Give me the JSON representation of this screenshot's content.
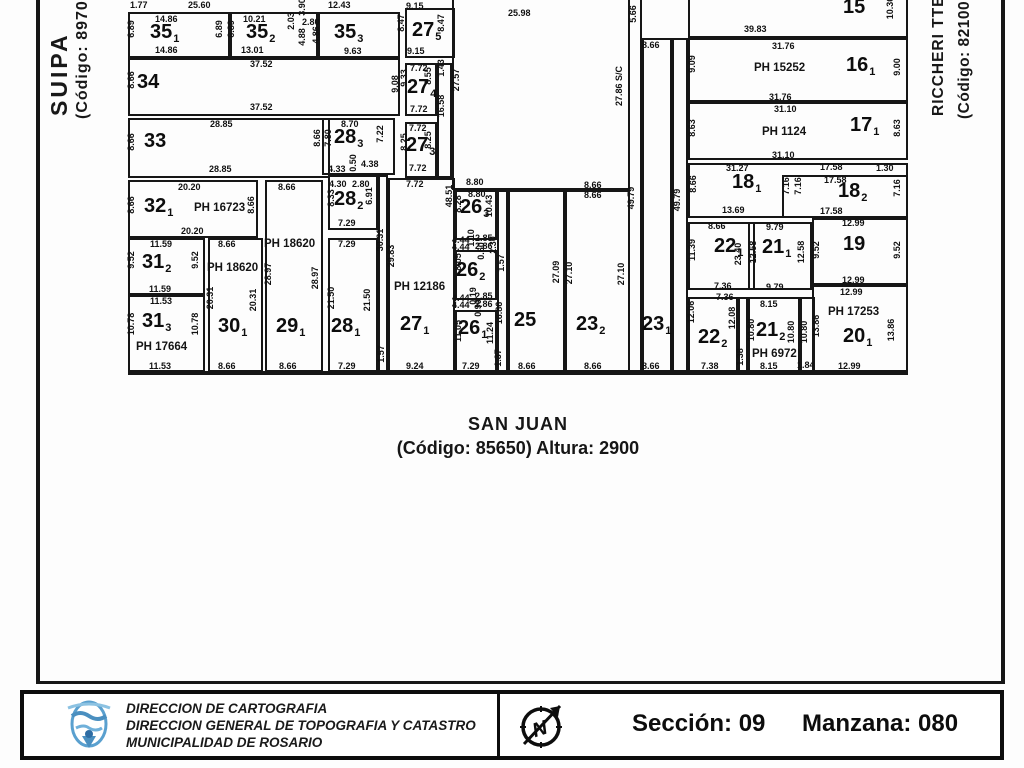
{
  "streets": {
    "left": {
      "name": "SUIPA",
      "code": "(Código: 89700"
    },
    "right": {
      "name": "RICCHERI TTE.",
      "code": "(Código: 82100"
    },
    "bottom": {
      "name": "SAN JUAN",
      "code": "(Código: 85650) Altura: 2900"
    }
  },
  "footer": {
    "org_lines": [
      "DIRECCION DE CARTOGRAFIA",
      "DIRECCION GENERAL DE TOPOGRAFIA Y CATASTRO",
      "MUNICIPALIDAD DE ROSARIO"
    ],
    "section_label": "Sección: 09",
    "manzana_label": "Manzana: 080",
    "compass_letter": "N"
  },
  "map": {
    "line_color": "#161616",
    "rects": [
      [
        128,
        12,
        102,
        46
      ],
      [
        230,
        12,
        88,
        46
      ],
      [
        318,
        12,
        82,
        46
      ],
      [
        405,
        8,
        50,
        50
      ],
      [
        128,
        58,
        272,
        58
      ],
      [
        405,
        63,
        32,
        53
      ],
      [
        437,
        63,
        15,
        115
      ],
      [
        128,
        118,
        202,
        60
      ],
      [
        322,
        118,
        73,
        57
      ],
      [
        405,
        122,
        32,
        56
      ],
      [
        128,
        180,
        130,
        58
      ],
      [
        328,
        175,
        50,
        55
      ],
      [
        128,
        238,
        77,
        57
      ],
      [
        128,
        295,
        77,
        77
      ],
      [
        208,
        238,
        55,
        134
      ],
      [
        265,
        180,
        58,
        192
      ],
      [
        328,
        238,
        50,
        134
      ],
      [
        378,
        175,
        10,
        197
      ],
      [
        388,
        178,
        67,
        194
      ],
      [
        452,
        -10,
        178,
        200
      ],
      [
        455,
        190,
        42,
        50
      ],
      [
        455,
        250,
        42,
        50
      ],
      [
        455,
        310,
        42,
        62
      ],
      [
        497,
        190,
        11,
        182
      ],
      [
        508,
        190,
        57,
        182
      ],
      [
        565,
        190,
        65,
        182
      ],
      [
        628,
        -10,
        14,
        382
      ],
      [
        642,
        38,
        30,
        334
      ],
      [
        672,
        38,
        16,
        334
      ],
      [
        688,
        -10,
        220,
        48
      ],
      [
        688,
        38,
        220,
        64
      ],
      [
        688,
        102,
        220,
        58
      ],
      [
        688,
        163,
        220,
        55
      ],
      [
        782,
        175,
        126,
        43
      ],
      [
        688,
        222,
        67,
        68
      ],
      [
        748,
        222,
        64,
        68
      ],
      [
        812,
        218,
        96,
        67
      ],
      [
        688,
        297,
        50,
        75
      ],
      [
        738,
        297,
        10,
        75
      ],
      [
        748,
        297,
        52,
        75
      ],
      [
        800,
        297,
        15,
        75
      ],
      [
        812,
        285,
        96,
        87
      ],
      [
        128,
        371,
        780,
        4,
        1
      ],
      [
        36,
        0,
        4,
        684,
        1
      ],
      [
        1001,
        0,
        4,
        684,
        1
      ],
      [
        36,
        681,
        969,
        3,
        1
      ]
    ],
    "parcels": [
      [
        "35",
        "1",
        150,
        22
      ],
      [
        "35",
        "2",
        246,
        22
      ],
      [
        "35",
        "3",
        334,
        22
      ],
      [
        "27",
        "5",
        412,
        20
      ],
      [
        "34",
        "",
        137,
        72
      ],
      [
        "27",
        "4",
        407,
        77
      ],
      [
        "33",
        "",
        144,
        131
      ],
      [
        "28",
        "3",
        334,
        127
      ],
      [
        "27",
        "3",
        406,
        135
      ],
      [
        "32",
        "1",
        144,
        196
      ],
      [
        "28",
        "2",
        334,
        189
      ],
      [
        "31",
        "2",
        142,
        252
      ],
      [
        "31",
        "3",
        142,
        311
      ],
      [
        "30",
        "1",
        218,
        316
      ],
      [
        "29",
        "1",
        276,
        316
      ],
      [
        "28",
        "1",
        331,
        316
      ],
      [
        "27",
        "1",
        400,
        314
      ],
      [
        "26",
        "3",
        460,
        197
      ],
      [
        "26",
        "2",
        456,
        260
      ],
      [
        "26",
        "1",
        458,
        318
      ],
      [
        "25",
        "",
        514,
        310
      ],
      [
        "23",
        "2",
        576,
        314
      ],
      [
        "23",
        "1",
        642,
        314
      ],
      [
        "15",
        "",
        843,
        -3
      ],
      [
        "16",
        "1",
        846,
        55
      ],
      [
        "17",
        "1",
        850,
        115
      ],
      [
        "18",
        "1",
        732,
        172
      ],
      [
        "18",
        "2",
        838,
        181
      ],
      [
        "22",
        "1",
        714,
        236
      ],
      [
        "21",
        "1",
        762,
        237
      ],
      [
        "19",
        "",
        843,
        234
      ],
      [
        "22",
        "2",
        698,
        327
      ],
      [
        "21",
        "2",
        756,
        320
      ],
      [
        "20",
        "1",
        843,
        326
      ]
    ],
    "ph_labels": [
      [
        "PH 16723",
        194,
        202
      ],
      [
        "PH 18620",
        264,
        238
      ],
      [
        "PH 18620",
        207,
        262
      ],
      [
        "PH 17664",
        136,
        341
      ],
      [
        "PH 12186",
        394,
        281
      ],
      [
        "PH 15252",
        754,
        62
      ],
      [
        "PH 1124",
        762,
        126
      ],
      [
        "PH 17253",
        828,
        306
      ],
      [
        "PH 6972",
        752,
        348
      ]
    ],
    "measurements": [
      [
        "1.77",
        130,
        1
      ],
      [
        "25.60",
        188,
        1
      ],
      [
        "12.43",
        328,
        1
      ],
      [
        "9.15",
        406,
        2
      ],
      [
        "25.98",
        508,
        9
      ],
      [
        "39.83",
        744,
        25
      ],
      [
        "8.66",
        642,
        41
      ],
      [
        "5.66",
        629,
        14,
        1
      ],
      [
        "10.36",
        886,
        8,
        1
      ],
      [
        "14.86",
        155,
        15
      ],
      [
        "6.89",
        127,
        29,
        1
      ],
      [
        "6.89",
        215,
        29,
        1
      ],
      [
        "14.86",
        155,
        46
      ],
      [
        "10.21",
        243,
        15
      ],
      [
        "6.89",
        227,
        29,
        1
      ],
      [
        "13.01",
        241,
        46
      ],
      [
        "2.03",
        287,
        21,
        1
      ],
      [
        "3.90",
        298,
        7,
        1
      ],
      [
        "2.80",
        302,
        18
      ],
      [
        "4.88",
        298,
        37,
        1
      ],
      [
        "4.86",
        312,
        35,
        1
      ],
      [
        "9.63",
        344,
        47
      ],
      [
        "8.47",
        397,
        23,
        1
      ],
      [
        "8.47",
        437,
        23,
        1
      ],
      [
        "9.15",
        407,
        47
      ],
      [
        "37.52",
        250,
        60
      ],
      [
        "8.66",
        127,
        80,
        1
      ],
      [
        "37.52",
        250,
        103
      ],
      [
        "9.08",
        391,
        84,
        1
      ],
      [
        "7.72",
        410,
        64
      ],
      [
        "9.33",
        400,
        78,
        1
      ],
      [
        "8.55",
        424,
        76,
        1
      ],
      [
        "7.72",
        410,
        105
      ],
      [
        "1.43",
        437,
        68,
        1
      ],
      [
        "16.58",
        437,
        106,
        1
      ],
      [
        "28.85",
        210,
        120
      ],
      [
        "8.66",
        127,
        142,
        1
      ],
      [
        "8.66",
        313,
        138,
        1
      ],
      [
        "28.85",
        209,
        165
      ],
      [
        "8.70",
        341,
        120
      ],
      [
        "7.80",
        324,
        138,
        1
      ],
      [
        "7.22",
        376,
        134,
        1
      ],
      [
        "4.33",
        328,
        165
      ],
      [
        "0.50",
        349,
        163,
        1
      ],
      [
        "4.38",
        361,
        160
      ],
      [
        "7.72",
        409,
        124
      ],
      [
        "8.25",
        400,
        142,
        1
      ],
      [
        "8.25",
        424,
        140,
        1
      ],
      [
        "7.72",
        409,
        164
      ],
      [
        "7.72",
        406,
        180
      ],
      [
        "20.20",
        178,
        183
      ],
      [
        "8.66",
        127,
        205,
        1
      ],
      [
        "8.66",
        247,
        205,
        1
      ],
      [
        "20.20",
        181,
        227
      ],
      [
        "4.30",
        329,
        180
      ],
      [
        "2.80",
        352,
        180
      ],
      [
        "8.33",
        327,
        198,
        1
      ],
      [
        "6.91",
        365,
        196,
        1
      ],
      [
        "7.29",
        338,
        219
      ],
      [
        "8.66",
        278,
        183
      ],
      [
        "28.97",
        264,
        274,
        1
      ],
      [
        "28.97",
        311,
        278,
        1
      ],
      [
        "8.66",
        279,
        362
      ],
      [
        "11.59",
        150,
        240
      ],
      [
        "9.52",
        127,
        260,
        1
      ],
      [
        "9.52",
        191,
        260,
        1
      ],
      [
        "11.59",
        149,
        285
      ],
      [
        "11.53",
        150,
        297
      ],
      [
        "10.78",
        127,
        324,
        1
      ],
      [
        "10.78",
        191,
        324,
        1
      ],
      [
        "11.53",
        149,
        362
      ],
      [
        "8.66",
        218,
        240
      ],
      [
        "20.31",
        206,
        298,
        1
      ],
      [
        "20.31",
        249,
        300,
        1
      ],
      [
        "8.66",
        218,
        362
      ],
      [
        "7.29",
        338,
        240
      ],
      [
        "21.50",
        327,
        298,
        1
      ],
      [
        "21.50",
        363,
        300,
        1
      ],
      [
        "7.29",
        338,
        362
      ],
      [
        "1.57",
        377,
        354,
        1
      ],
      [
        "30.31",
        376,
        240,
        1
      ],
      [
        "29.83",
        387,
        256,
        1
      ],
      [
        "48.51",
        445,
        196,
        1
      ],
      [
        "9.24",
        406,
        362
      ],
      [
        "27.57",
        452,
        80,
        1
      ],
      [
        "27.86 S/C",
        615,
        86,
        1
      ],
      [
        "8.80",
        466,
        178
      ],
      [
        "8.80",
        468,
        190
      ],
      [
        "8.28",
        454,
        204,
        1
      ],
      [
        "10.43",
        485,
        206,
        1
      ],
      [
        "4.44",
        452,
        236
      ],
      [
        "2.85",
        475,
        234
      ],
      [
        "1.10",
        467,
        238,
        1
      ],
      [
        "4.44",
        452,
        243
      ],
      [
        "2.86",
        475,
        242
      ],
      [
        "2.30",
        489,
        245,
        1
      ],
      [
        "8.05",
        454,
        262,
        1
      ],
      [
        "0.60",
        477,
        251,
        1
      ],
      [
        "1.57",
        497,
        263,
        1
      ],
      [
        "4.44",
        452,
        294
      ],
      [
        "2.85",
        475,
        292
      ],
      [
        "0.19",
        469,
        296,
        1
      ],
      [
        "4.44",
        452,
        301
      ],
      [
        "2.86",
        475,
        300
      ],
      [
        "0.90",
        474,
        308,
        1
      ],
      [
        "11.05",
        454,
        331,
        1
      ],
      [
        "11.24",
        486,
        333,
        1
      ],
      [
        "7.29",
        462,
        362
      ],
      [
        "16.86",
        495,
        313,
        1
      ],
      [
        "1.37",
        494,
        358,
        1
      ],
      [
        "27.09",
        552,
        272,
        1
      ],
      [
        "8.66",
        518,
        362
      ],
      [
        "8.66",
        584,
        181
      ],
      [
        "8.66",
        584,
        191
      ],
      [
        "27.10",
        565,
        273,
        1
      ],
      [
        "27.10",
        617,
        274,
        1
      ],
      [
        "8.66",
        584,
        362
      ],
      [
        "49.79",
        627,
        198,
        1
      ],
      [
        "49.79",
        673,
        200,
        1
      ],
      [
        "8.66",
        642,
        362
      ],
      [
        "31.76",
        772,
        42
      ],
      [
        "9.09",
        688,
        64,
        1
      ],
      [
        "9.00",
        893,
        67,
        1
      ],
      [
        "31.76",
        769,
        93
      ],
      [
        "31.10",
        774,
        105
      ],
      [
        "8.63",
        688,
        128,
        1
      ],
      [
        "8.63",
        893,
        128,
        1
      ],
      [
        "31.10",
        772,
        151
      ],
      [
        "31.27",
        726,
        164
      ],
      [
        "17.58",
        820,
        163
      ],
      [
        "1.30",
        876,
        164
      ],
      [
        "17.58",
        824,
        176
      ],
      [
        "8.66",
        689,
        184,
        1
      ],
      [
        "7.16",
        782,
        186,
        1
      ],
      [
        "7.16",
        794,
        186,
        1
      ],
      [
        "7.16",
        893,
        188,
        1
      ],
      [
        "13.69",
        722,
        206
      ],
      [
        "17.58",
        820,
        207
      ],
      [
        "8.66",
        708,
        222
      ],
      [
        "11.39",
        688,
        250,
        1
      ],
      [
        "23.40",
        734,
        254,
        1
      ],
      [
        "7.36",
        714,
        282
      ],
      [
        "7.36",
        716,
        293
      ],
      [
        "9.79",
        766,
        223
      ],
      [
        "12.58",
        749,
        252,
        1
      ],
      [
        "12.58",
        797,
        252,
        1
      ],
      [
        "9.79",
        766,
        283
      ],
      [
        "12.99",
        842,
        219
      ],
      [
        "9.52",
        812,
        250,
        1
      ],
      [
        "9.52",
        893,
        250,
        1
      ],
      [
        "12.99",
        842,
        276
      ],
      [
        "12.99",
        840,
        288
      ],
      [
        "13.86",
        812,
        326,
        1
      ],
      [
        "13.86",
        887,
        330,
        1
      ],
      [
        "12.99",
        838,
        362
      ],
      [
        "12.06",
        687,
        312,
        1
      ],
      [
        "12.08",
        728,
        318,
        1
      ],
      [
        "7.38",
        701,
        362
      ],
      [
        "1.38",
        736,
        357,
        1
      ],
      [
        "8.15",
        760,
        300
      ],
      [
        "10.80",
        747,
        330,
        1
      ],
      [
        "10.80",
        787,
        332,
        1
      ],
      [
        "8.15",
        760,
        362
      ],
      [
        "10.80",
        800,
        332,
        1
      ],
      [
        "1.84",
        797,
        361
      ]
    ]
  }
}
